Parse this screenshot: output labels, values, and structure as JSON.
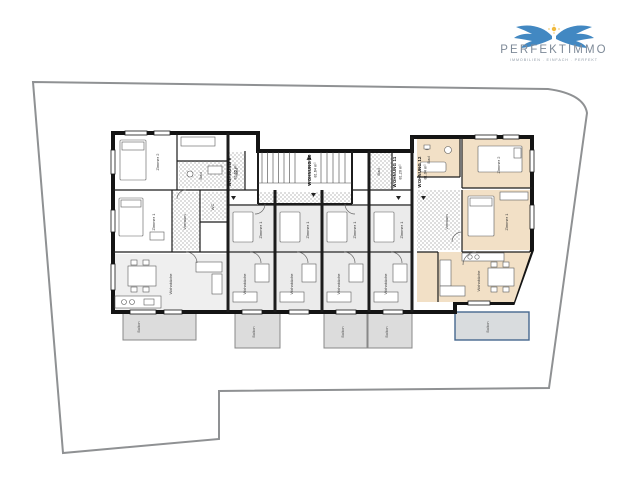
{
  "logo": {
    "brand": "PERFEKTIMMO",
    "tagline": "IMMOBILIEN . EINFACH . PERFEKT"
  },
  "plan": {
    "units": [
      {
        "label": "WOHNUNG 9",
        "area": "81.65 m²"
      },
      {
        "label": "WOHNUNG 10",
        "area": "81.64 m²"
      },
      {
        "label": "WOHNUNG 11",
        "area": "81.20 m²"
      },
      {
        "label": "WOHNUNG 12",
        "area": "81.04 m²"
      }
    ],
    "room_labels": {
      "zimmer1": "Zimmer 1",
      "zimmer2": "Zimmer 2",
      "bad": "Bad",
      "wc": "WC",
      "vorraum": "Vorraum",
      "wohnkueche": "Wohnküche",
      "balkon": "Balkon"
    },
    "colors": {
      "highlight_fill": "#f2e0c6",
      "balcony_fill": "#dcdcdc",
      "balcony_highlight_border": "#46688e",
      "boundary": "#8f9193",
      "wall": "#141414",
      "logo_blue": "#4288c2",
      "logo_star": "#f0b93c"
    }
  }
}
